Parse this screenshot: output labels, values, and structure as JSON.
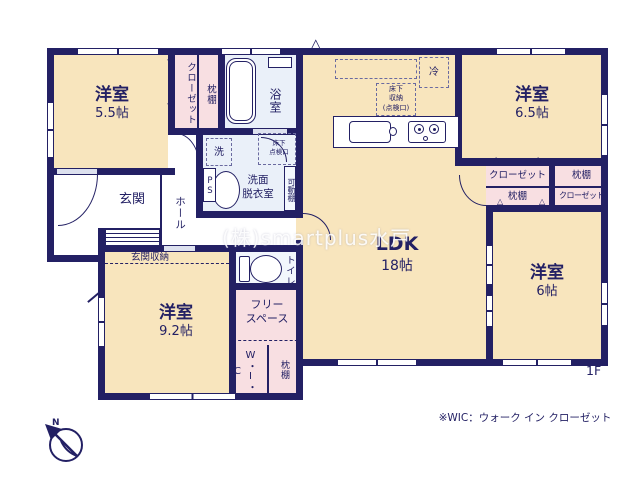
{
  "palette": {
    "wall": "#232064",
    "room_fill": "#f8e5bd",
    "closet_fill": "#f8dfe2",
    "wet_fill": "#eaf0f9",
    "ink": "#232064",
    "watermark": "#ffffff"
  },
  "floor": {
    "label": "1F"
  },
  "note": "※WIC：ウォーク イン クローゼット",
  "watermark": "(株)smartplus水戸",
  "compass": {
    "n": "N"
  },
  "rooms": {
    "bedroom55": {
      "name": "洋室",
      "size": "5.5帖"
    },
    "bedroom65": {
      "name": "洋室",
      "size": "6.5帖"
    },
    "bedroom6": {
      "name": "洋室",
      "size": "6帖"
    },
    "bedroom92": {
      "name": "洋室",
      "size": "9.2帖"
    },
    "ldk": {
      "name": "LDK",
      "size": "18帖"
    },
    "bath": "浴室",
    "washroom": {
      "line1": "洗面",
      "line2": "脱衣室"
    },
    "toilet": "トイレ",
    "genkan": "玄関",
    "hall": "ホール",
    "genkan_storage": "玄関収納",
    "free_space": {
      "line1": "フリー",
      "line2": "スペース"
    },
    "wic": "W・I・C"
  },
  "fixtures": {
    "washer": "洗",
    "fridge": "冷",
    "ps": "PS",
    "movable_shelf": "可動棚",
    "closet": "クローゼット",
    "pillow_shelf": "枕棚",
    "underfloor_hatch": {
      "line1": "床下",
      "line2": "点検口"
    },
    "underfloor_storage": {
      "line1": "床下",
      "line2": "収納",
      "line3": "(点検口)"
    }
  },
  "icons": {
    "fold_left": "◁",
    "fold_up": "△",
    "gable_vent": "△"
  }
}
